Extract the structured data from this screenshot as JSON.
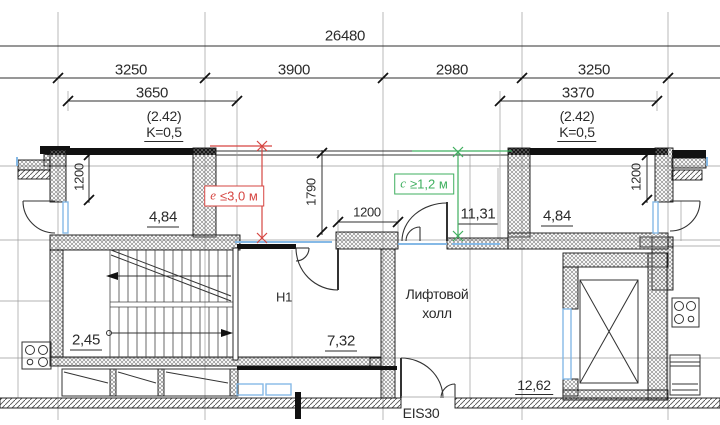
{
  "plan": {
    "dimensions": {
      "total": "26480",
      "grid": [
        "3250",
        "3900",
        "2980",
        "3250"
      ],
      "left_parapet": "3650",
      "right_parapet": "3370",
      "left_room_width": "1200",
      "terrace_depth": "1790",
      "mid_pier": "1200",
      "right_room_width": "1200"
    },
    "coefficients": {
      "left": {
        "value": "(2.42)",
        "k": "K=0,5"
      },
      "right": {
        "value": "(2.42)",
        "k": "K=0,5"
      }
    },
    "areas": {
      "left_balcony": "4,84",
      "right_balcony": "4,84",
      "terrace": "11,31",
      "stairs": "2,45",
      "corridor": "7,32",
      "lift_lobby": "12,62"
    },
    "labels": {
      "corridor": "H1",
      "lift_lobby_line1": "Лифтовой",
      "lift_lobby_line2": "холл",
      "door_rating": "EIS30"
    },
    "notes": {
      "red": {
        "variable": "e",
        "condition": "≤3,0 м"
      },
      "green": {
        "variable": "c",
        "condition": "≥1,2 м"
      }
    },
    "colors": {
      "annotation_red": "#d64541",
      "annotation_green": "#3faf5f",
      "glazing_blue": "#85b9e6",
      "line_dark": "#1a1a1a"
    }
  }
}
